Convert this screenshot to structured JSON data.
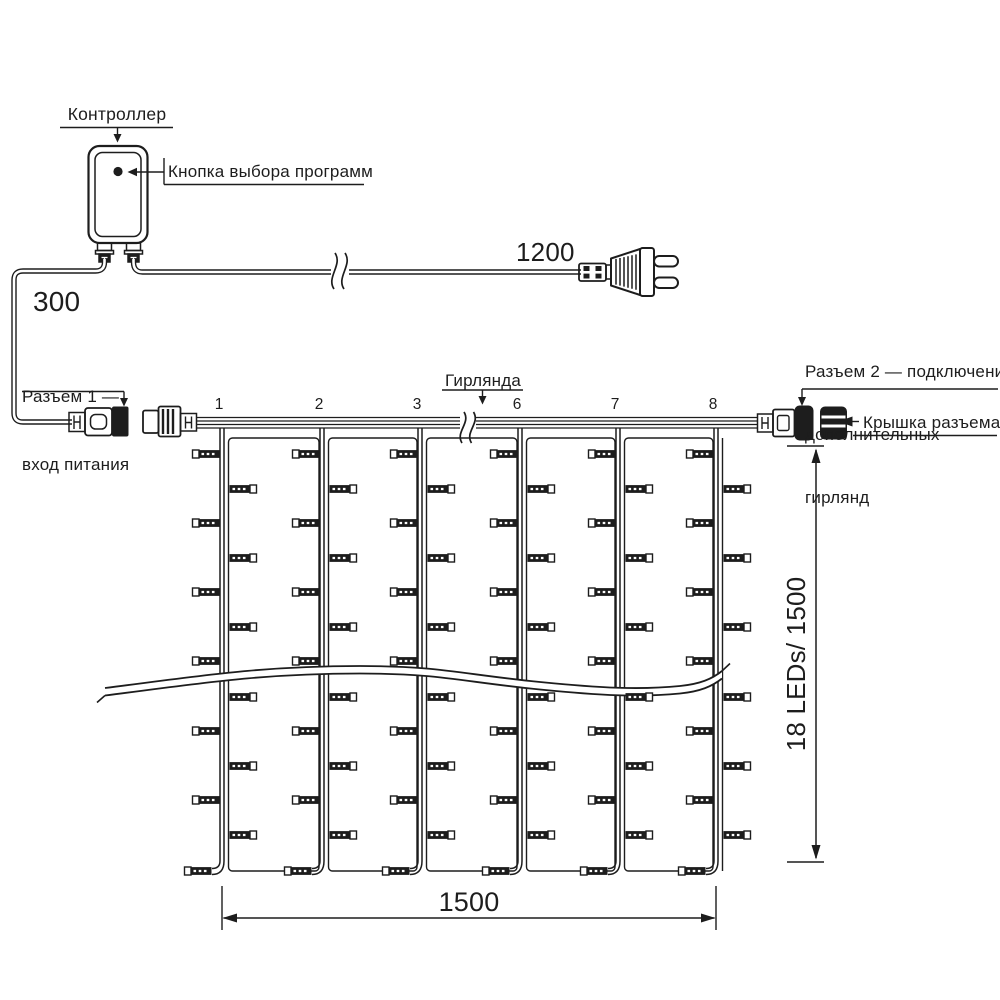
{
  "colors": {
    "ink": "#1d1d1d",
    "background": "#ffffff"
  },
  "controller": {
    "label": "Контроллер",
    "program_button_label": "Кнопка выбора программ"
  },
  "cable_lengths": {
    "power_input_cable": "300",
    "plug_cable": "1200"
  },
  "labels": {
    "connector1_line1": "Разъем 1 —",
    "connector1_line2": "вход питания",
    "garland": "Гирлянда",
    "connector2_line1": "Разъем 2 — подключение",
    "connector2_line2": "дополнительных",
    "connector2_line3": "гирлянд",
    "connector_cap": "Крышка разъема"
  },
  "strand_numbers": [
    "1",
    "2",
    "3",
    "6",
    "7",
    "8"
  ],
  "dimensions": {
    "curtain_width": "1500",
    "curtain_height": "18 LEDs/ 1500"
  }
}
